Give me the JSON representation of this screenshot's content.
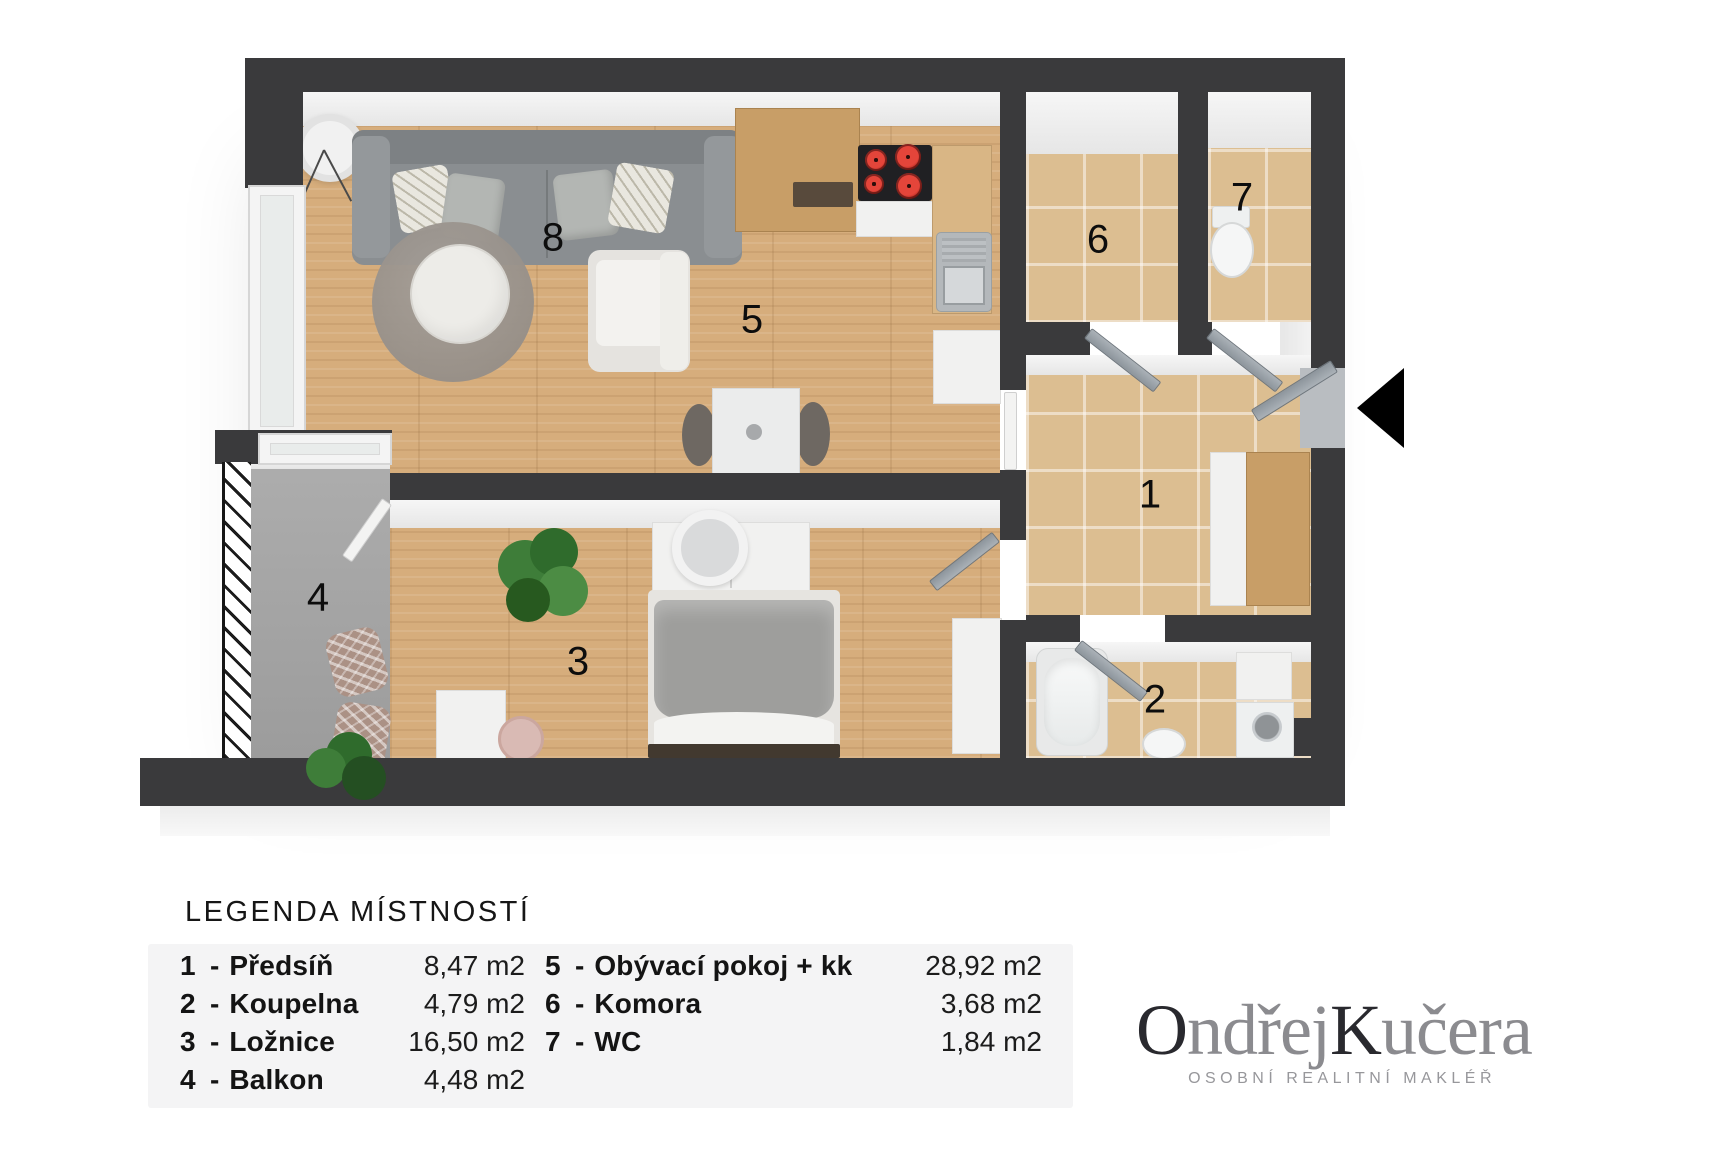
{
  "plan": {
    "labels": [
      {
        "text": "1"
      },
      {
        "text": "2"
      },
      {
        "text": "3"
      },
      {
        "text": "4"
      },
      {
        "text": "5"
      },
      {
        "text": "6"
      },
      {
        "text": "7"
      },
      {
        "text": "8"
      }
    ],
    "entrance_marker": "left-pointing-triangle"
  },
  "legend": {
    "title": "LEGENDA MÍSTNOSTÍ",
    "separator": "-",
    "col1": [
      {
        "num": "1",
        "name": "Předsíň",
        "area": "8,47 m2"
      },
      {
        "num": "2",
        "name": "Koupelna",
        "area": "4,79 m2"
      },
      {
        "num": "3",
        "name": "Ložnice",
        "area": "16,50 m2"
      },
      {
        "num": "4",
        "name": "Balkon",
        "area": "4,48 m2"
      }
    ],
    "col2": [
      {
        "num": "5",
        "name": "Obývací pokoj + kk",
        "area": "28,92 m2"
      },
      {
        "num": "6",
        "name": "Komora",
        "area": "3,68 m2"
      },
      {
        "num": "7",
        "name": "WC",
        "area": "1,84 m2"
      }
    ]
  },
  "brand": {
    "part1": "O",
    "part2": "ndřej",
    "part3": "K",
    "part4": "učera",
    "tagline": "OSOBNÍ REALITNÍ MAKLÉŘ"
  },
  "colors": {
    "wall": "#3a3a3c",
    "wood_floor": "#d6ad7c",
    "tile_floor": "#dcbe91",
    "balcony_floor": "#a6a6a6",
    "door": "#98a0a8",
    "burner_red": "#d8332c",
    "brand_dark": "#29292e",
    "brand_gray": "#8b8b8f"
  }
}
